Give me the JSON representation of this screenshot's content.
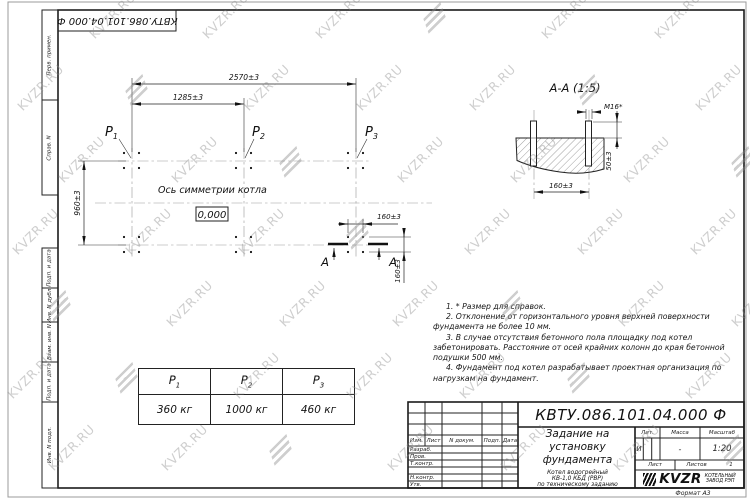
{
  "watermark": {
    "text": "KVZR.RU"
  },
  "corner_stamp": {
    "text": "КВТУ.086.101.04.000  Ф"
  },
  "margin_labels": [
    "Перв. примен.",
    "Справ. N",
    "Подп. и дата",
    "Инв. N дубл.",
    "Взам. инв. N",
    "Подп. и дата",
    "Инв. N подл."
  ],
  "plan": {
    "dim_total": "2570±3",
    "dim_half": "1285±3",
    "dim_vertical": "960±3",
    "dim_bolt_h": "160±3",
    "dim_bolt_v": "160±3",
    "axis_label": "Ось симметрии котла",
    "elevation": "0,000",
    "p1": {
      "letter": "P",
      "sub": "1"
    },
    "p2": {
      "letter": "P",
      "sub": "2"
    },
    "p3": {
      "letter": "P",
      "sub": "3"
    },
    "section_mark_left": "A",
    "section_mark_right": "A"
  },
  "section": {
    "title": "А-А (1:5)",
    "thread": "M16*",
    "dim_protrusion": "50±3",
    "dim_spacing": "160±3"
  },
  "notes": [
    "1. * Размер для справок.",
    "2. Отклонение от горизонтального уровня верхней поверхности фундамента не более 10 мм.",
    "3. В случае отсутствия бетонного пола площадку под котел забетонировать. Расстояние от осей крайних колонн до края бетонной подушки 500 мм.",
    "4. Фундамент под котел разрабатывает проектная организация по нагрузкам на фундамент."
  ],
  "load_table": {
    "headers": [
      {
        "letter": "P",
        "sub": "1"
      },
      {
        "letter": "P",
        "sub": "2"
      },
      {
        "letter": "P",
        "sub": "3"
      }
    ],
    "values": [
      "360 кг",
      "1000 кг",
      "460 кг"
    ]
  },
  "title_block": {
    "designation": "КВТУ.086.101.04.000  Ф",
    "doc_title": [
      "Задание на",
      "установку",
      "фундамента"
    ],
    "product": [
      "Котел водогрейный",
      "КВ-1,0 КБД (РВР)",
      "по техническому заданию"
    ],
    "rev_headers": [
      "Изм.",
      "Лист",
      "N докум.",
      "Подп.",
      "Дата"
    ],
    "sign_labels": [
      "Разраб.",
      "Пров.",
      "Т.контр.",
      "Н.контр.",
      "Утв."
    ],
    "lit_label": "Лит.",
    "lit_value": "И",
    "mass_label": "Масса",
    "mass_value": "-",
    "scale_label": "Масштаб",
    "scale_value": "1:20",
    "sheet_label": "Лист",
    "sheets_label": "Листов",
    "sheets_value": "1",
    "logo": {
      "name": "KVZR",
      "line1": "КОТЕЛЬНЫЙ",
      "line2": "ЗАВОД РЭП"
    },
    "format_note": "Формат А3"
  }
}
